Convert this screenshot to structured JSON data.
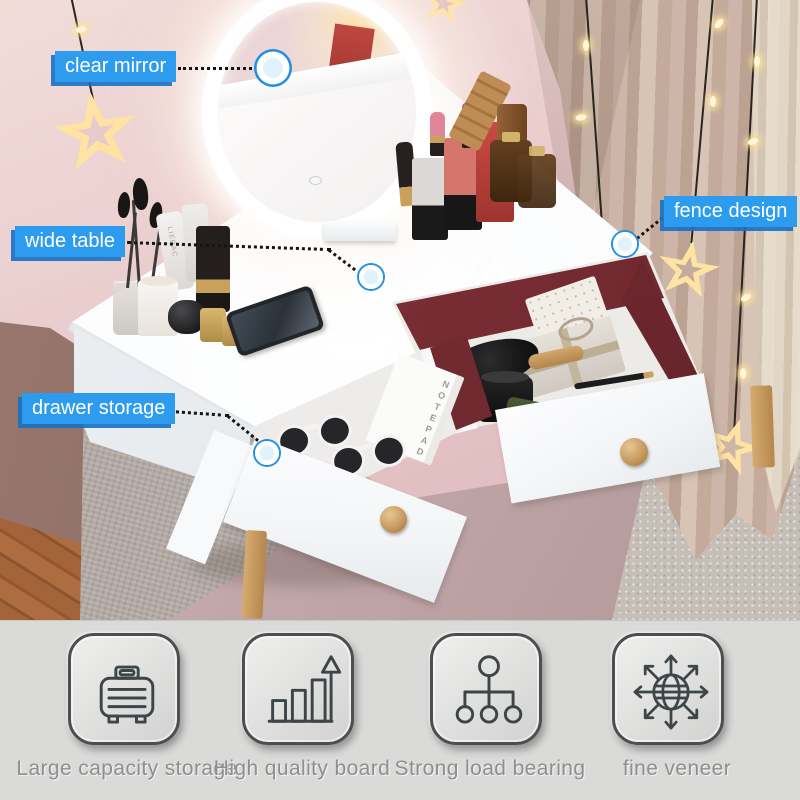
{
  "callouts": [
    {
      "id": "clear-mirror",
      "label": "clear mirror"
    },
    {
      "id": "wide-table",
      "label": "wide table"
    },
    {
      "id": "fence-design",
      "label": "fence design"
    },
    {
      "id": "drawer-storage",
      "label": "drawer storage"
    }
  ],
  "features": [
    {
      "icon": "suitcase-icon",
      "label": "Large capacity storage"
    },
    {
      "icon": "bar-chart-growth-icon",
      "label": "High quality board"
    },
    {
      "icon": "org-tree-icon",
      "label": "Strong load bearing"
    },
    {
      "icon": "globe-arrows-icon",
      "label": "fine veneer"
    }
  ],
  "photo_texts": {
    "notepad": "NOTEPAD",
    "tube_brand": "LIERAC"
  },
  "colors": {
    "callout_blue": "#2d9bee",
    "callout_blue_dark": "#1a74c8",
    "marker_ring_blue": "#1f8fe8",
    "feature_panel_bg": "#dadad9",
    "feature_label_text": "#8e8e8e",
    "feature_icon_stroke": "#3d4549",
    "drawer_interior_red": "#7c3036",
    "vanity_white": "#fafbfc",
    "wood_accent": "#c9a066",
    "wall_pink": "#e8caca",
    "curtain_beige": "#c3ab9d",
    "led_glow": "#ffffff",
    "star_warm": "#ffe3a3"
  }
}
